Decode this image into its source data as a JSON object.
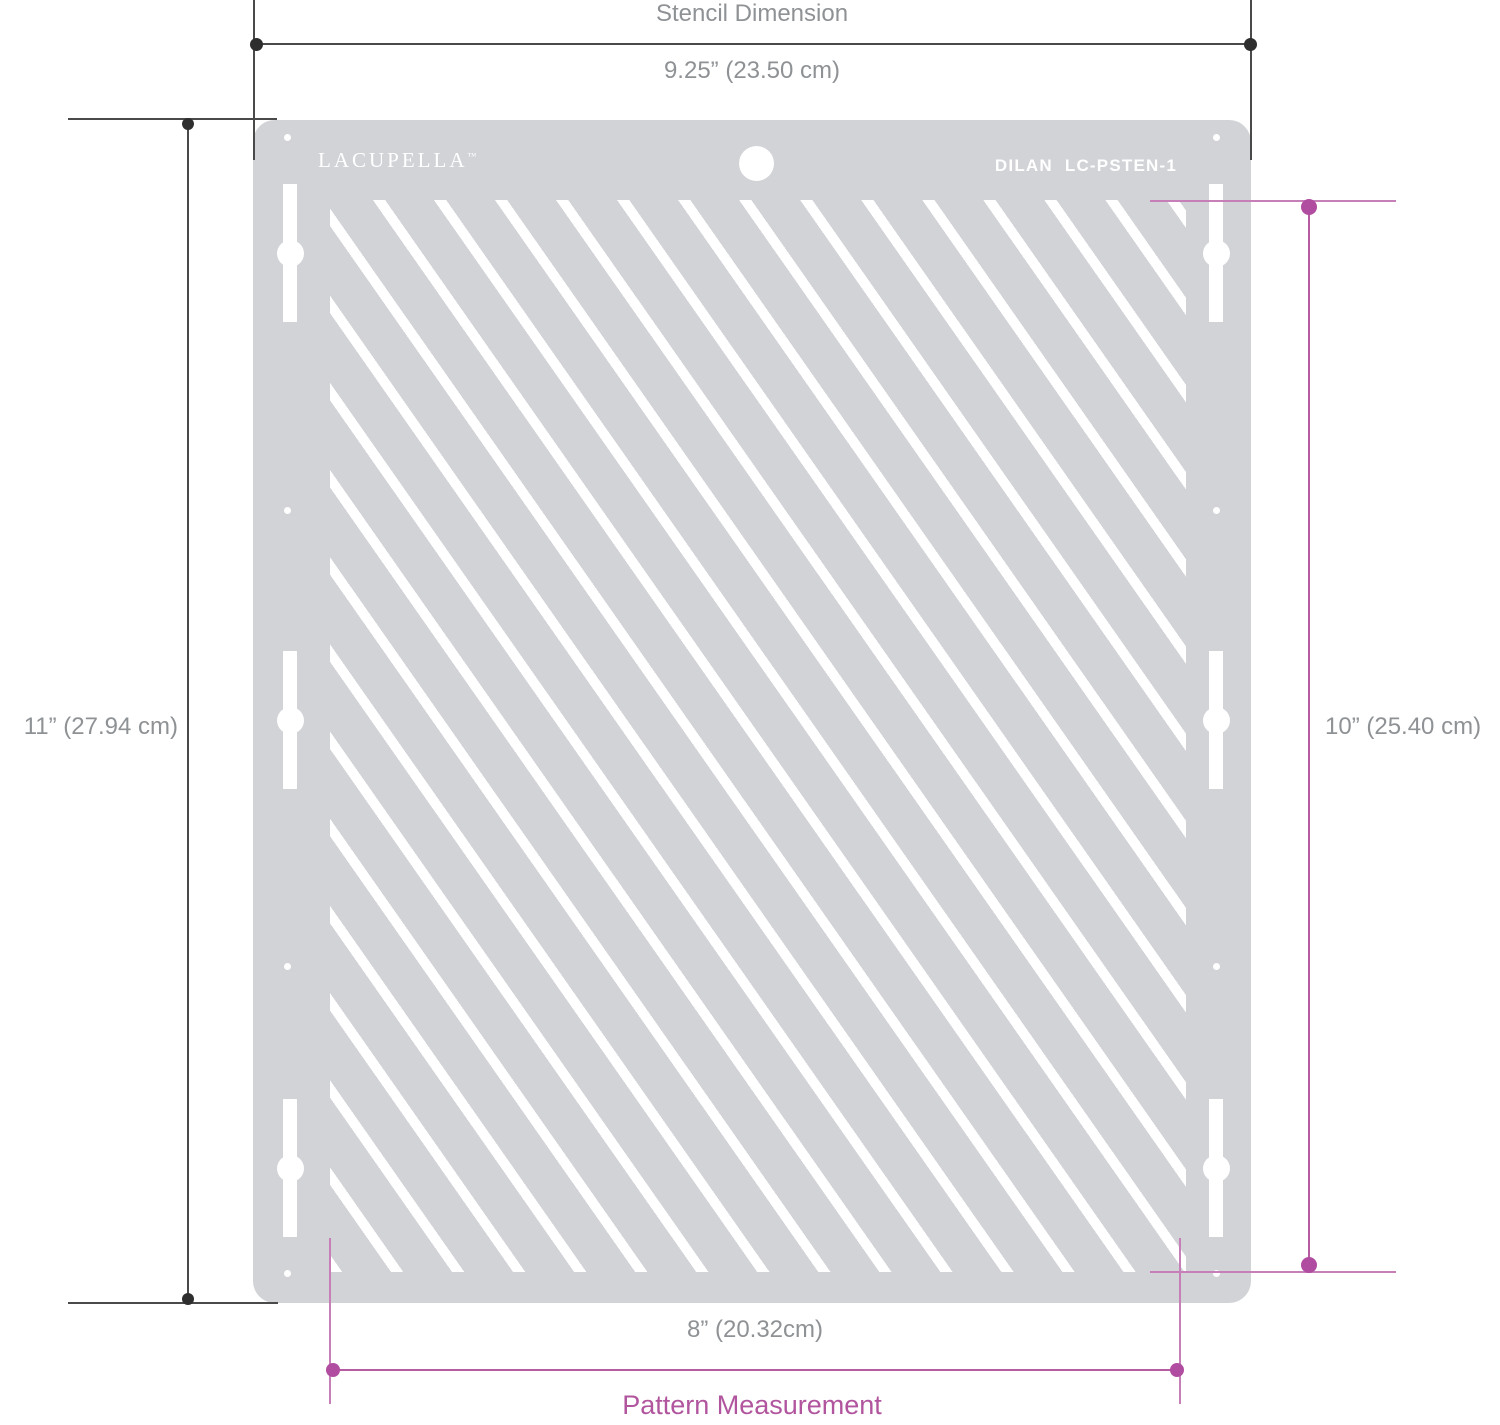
{
  "product": {
    "brand": "LACUPELLA",
    "brand_tm": "TM",
    "model_name": "DILAN",
    "model_code": "LC-PSTEN-1"
  },
  "stencil_dimension": {
    "title": "Stencil Dimension",
    "width_label": "9.25” (23.50 cm)",
    "height_label": "11” (27.94 cm)"
  },
  "pattern_measurement": {
    "title": "Pattern Measurement",
    "width_label": "8” (20.32cm)",
    "height_label": "10” (25.40 cm)"
  },
  "colors": {
    "plate_gray": "#d1d3d7",
    "stripe_white": "#ffffff",
    "dimension_dark": "#4a4a4a",
    "dimension_dot_dark": "#2e2e2e",
    "label_gray": "#8f9295",
    "accent_pink": "#b75ba2",
    "accent_pink_dot": "#b04da0"
  }
}
